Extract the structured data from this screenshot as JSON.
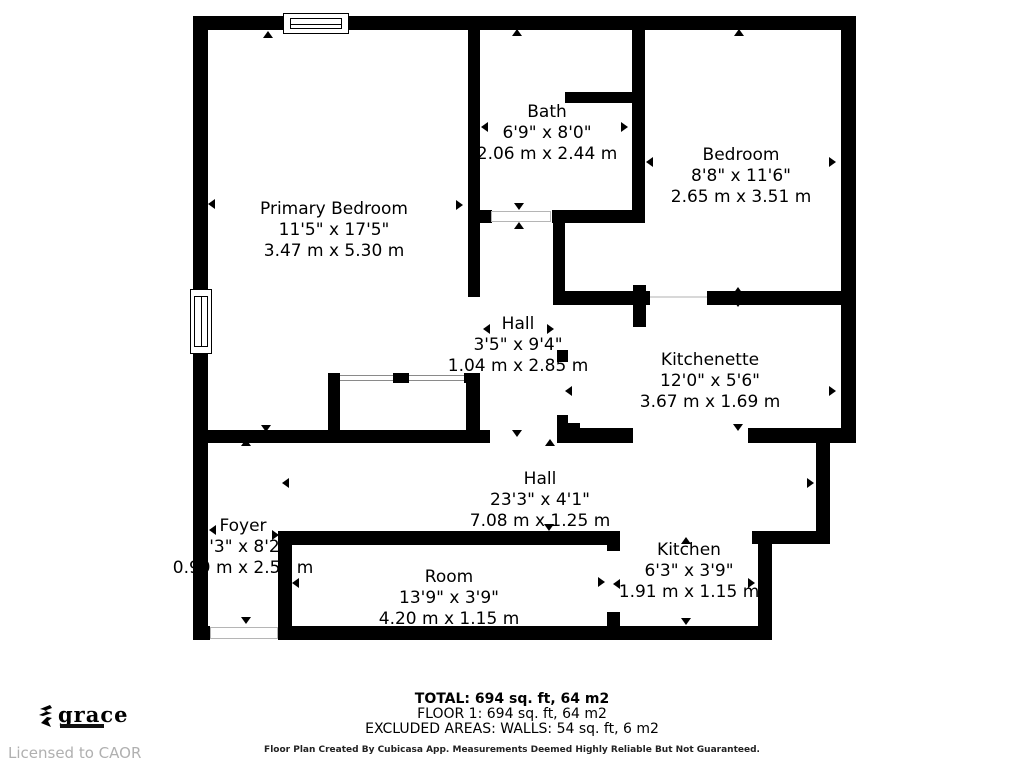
{
  "rooms": [
    {
      "name": "Primary Bedroom",
      "imperial": "11'5\" x 17'5\"",
      "metric": "3.47 m x 5.30 m"
    },
    {
      "name": "Bath",
      "imperial": "6'9\" x 8'0\"",
      "metric": "2.06 m x 2.44 m"
    },
    {
      "name": "Bedroom",
      "imperial": "8'8\" x 11'6\"",
      "metric": "2.65 m x 3.51 m"
    },
    {
      "name": "Hall",
      "imperial": "3'5\" x 9'4\"",
      "metric": "1.04 m x 2.85 m"
    },
    {
      "name": "Kitchenette",
      "imperial": "12'0\" x 5'6\"",
      "metric": "3.67 m x 1.69 m"
    },
    {
      "name": "Hall",
      "imperial": "23'3\" x 4'1\"",
      "metric": "7.08 m x 1.25 m"
    },
    {
      "name": "Foyer",
      "imperial": "3'3\" x 8'2\"",
      "metric": "0.99 m x 2.50 m"
    },
    {
      "name": "Room",
      "imperial": "13'9\" x 3'9\"",
      "metric": "4.20 m x 1.15 m"
    },
    {
      "name": "Kitchen",
      "imperial": "6'3\" x 3'9\"",
      "metric": "1.91 m x 1.15 m"
    }
  ],
  "summary": {
    "total": "TOTAL: 694 sq. ft, 64 m2",
    "floor1": "FLOOR 1: 694 sq. ft, 64 m2",
    "excluded": "EXCLUDED AREAS: WALLS: 54 sq. ft, 6 m2",
    "disclaimer": "Floor Plan Created By Cubicasa App. Measurements Deemed Highly Reliable But Not Guaranteed."
  },
  "branding": {
    "logo_text": "grace",
    "license_text": "Licensed to CAOR"
  },
  "colors": {
    "wall": "#000000",
    "background": "#ffffff",
    "license_gray": "#b0b0b0"
  }
}
